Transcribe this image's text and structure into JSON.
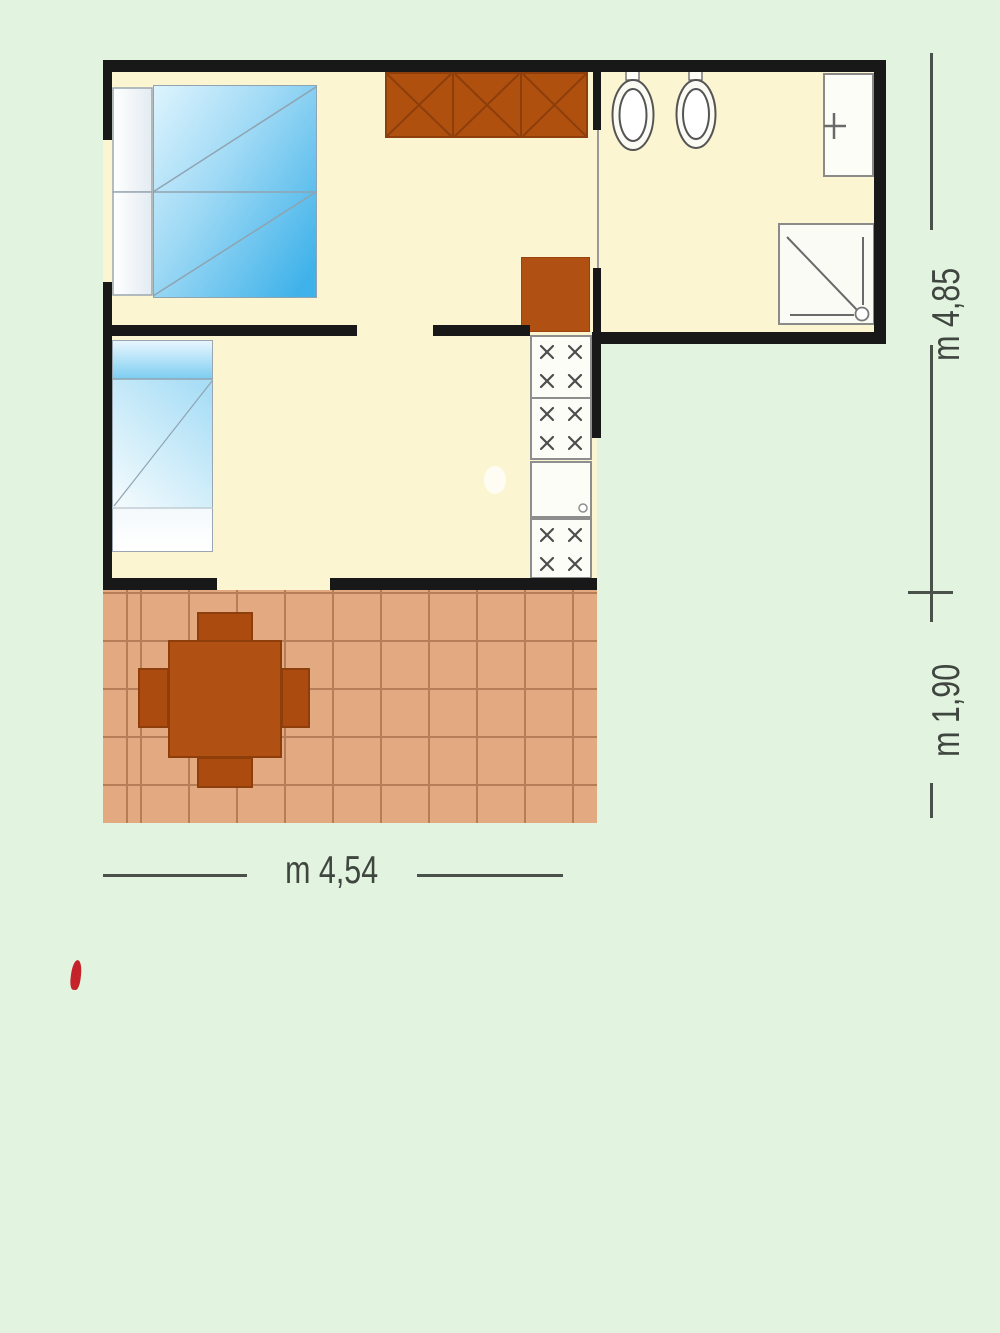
{
  "plan": {
    "type": "floor-plan",
    "rooms": [
      "bedroom-double",
      "bedroom-single-living",
      "bathroom",
      "kitchen-strip",
      "terrace"
    ],
    "fixtures": [
      "double-bed",
      "single-bed",
      "wardrobe",
      "storage-cabinet",
      "kitchen-units",
      "kitchen-sink",
      "toilet",
      "toilet",
      "washbasin",
      "shower",
      "terrace-table",
      "terrace-chairs"
    ]
  },
  "dimensions": {
    "right_upper": "m 4,85",
    "right_lower": "m 1,90",
    "bottom": "m 4,54"
  },
  "colors": {
    "background": "#e2f3df",
    "wall": "#181818",
    "floor": "#fbf6d1",
    "terrace_tile": "#e3a980",
    "terrace_grout": "#b57e58",
    "furniture_wood": "#b05013",
    "furniture_wood_dark": "#8d3e0b",
    "bed_blue": "#3fb2e9",
    "fixture_outline": "#8a8a8a",
    "dimension_text": "#3f453f",
    "accent_red": "#c4232a"
  }
}
